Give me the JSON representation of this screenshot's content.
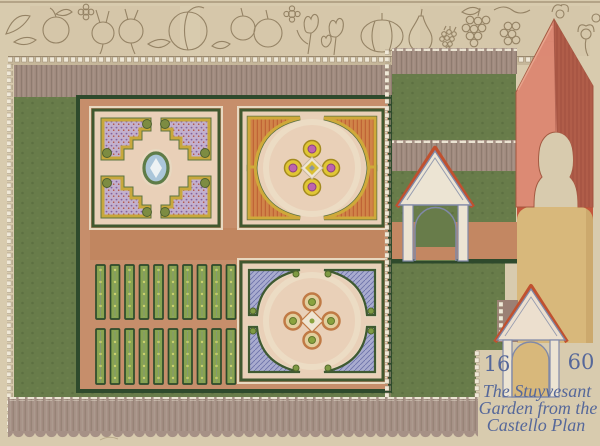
{
  "artwork": {
    "date_left": "16",
    "date_right": "60",
    "title_line1": "The Stuyvesant",
    "title_line2": "Garden from the",
    "title_line3": "Castello Plan"
  },
  "frieze_items": [
    "leaves",
    "apple",
    "flower",
    "turnips",
    "peach",
    "apples",
    "tulips",
    "melon",
    "pear",
    "raspberry",
    "grapes",
    "poppies"
  ],
  "palette": {
    "paper": "#d8cbae",
    "frieze_line": "#8e7c5e",
    "wall_mauve": "#a18b7f",
    "fence_mauve": "#a69186",
    "lawn_green": "#687c4a",
    "hedge_dark": "#2e4a2c",
    "terracotta": "#c38762",
    "path_terracotta": "#c68e6b",
    "parterre_pink": "#e9d0b8",
    "parterre_green": "#40582f",
    "bed_yellow": "#c8a83c",
    "bed_orange": "#d08448",
    "bed_lavender": "#c3b0cd",
    "bed_blue": "#a9accf",
    "accent_magenta": "#bd64ae",
    "pond_blue": "#abc6da",
    "tower_salmon": "#dd8873",
    "tower_shadow": "#b05d49",
    "column_tan": "#d8b87b",
    "gate_cream": "#ece4d3",
    "gate_outline": "#8089a8",
    "roof_red": "#c0512f",
    "bead_white": "#efe8d7",
    "ink_blue": "#56689a"
  }
}
